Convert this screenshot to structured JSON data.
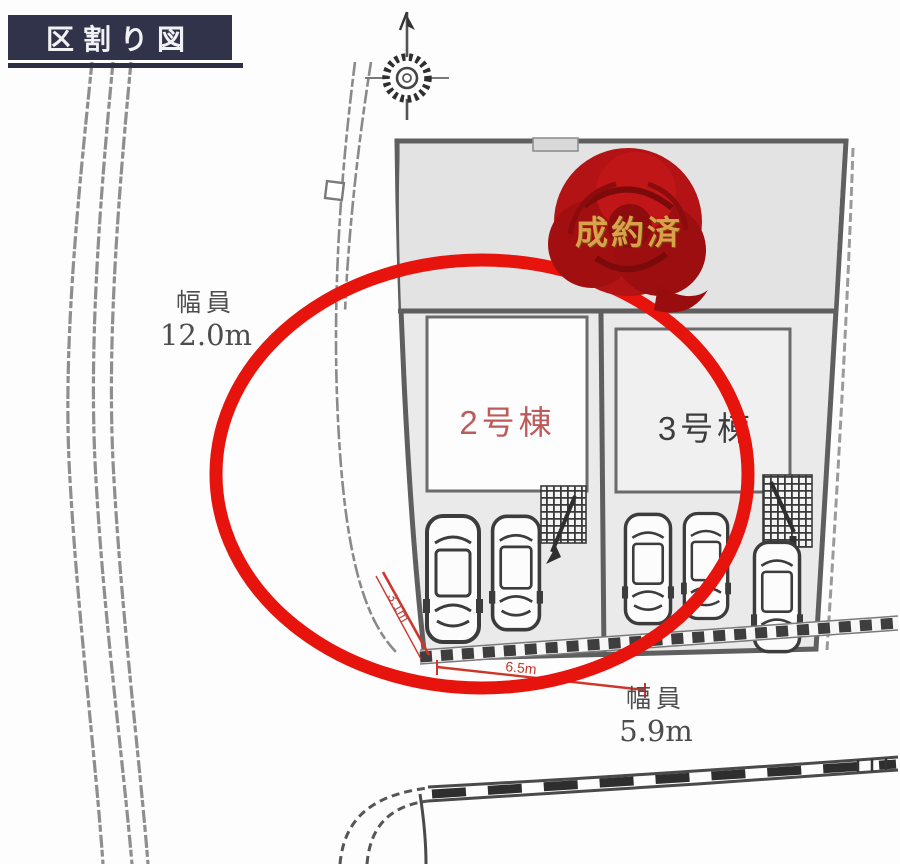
{
  "header": {
    "title": "区割り図"
  },
  "icons": {
    "compass": "compass-north-icon",
    "rose": "sold-rose-icon"
  },
  "roads": {
    "left": {
      "width_label": "幅員",
      "width_value": "12.0m"
    },
    "front": {
      "width_label": "幅員",
      "width_value": "5.9m"
    }
  },
  "site": {
    "sold_lot": {
      "stamp": "成約済"
    },
    "lot2": {
      "label": "2号棟"
    },
    "lot3": {
      "label": "3号棟"
    }
  },
  "dimensions": {
    "splay": "3.1m",
    "frontage": "6.5m"
  },
  "colors": {
    "badge_bg": "#303349",
    "highlight_red": "#e7130d",
    "lot2_label": "#bc5b5b",
    "stamp_gold": "#d8a24b",
    "rose_red": "#a80f10",
    "boundary_gray": "#5f5f5f",
    "road_line_gray": "#8e8e8e"
  }
}
